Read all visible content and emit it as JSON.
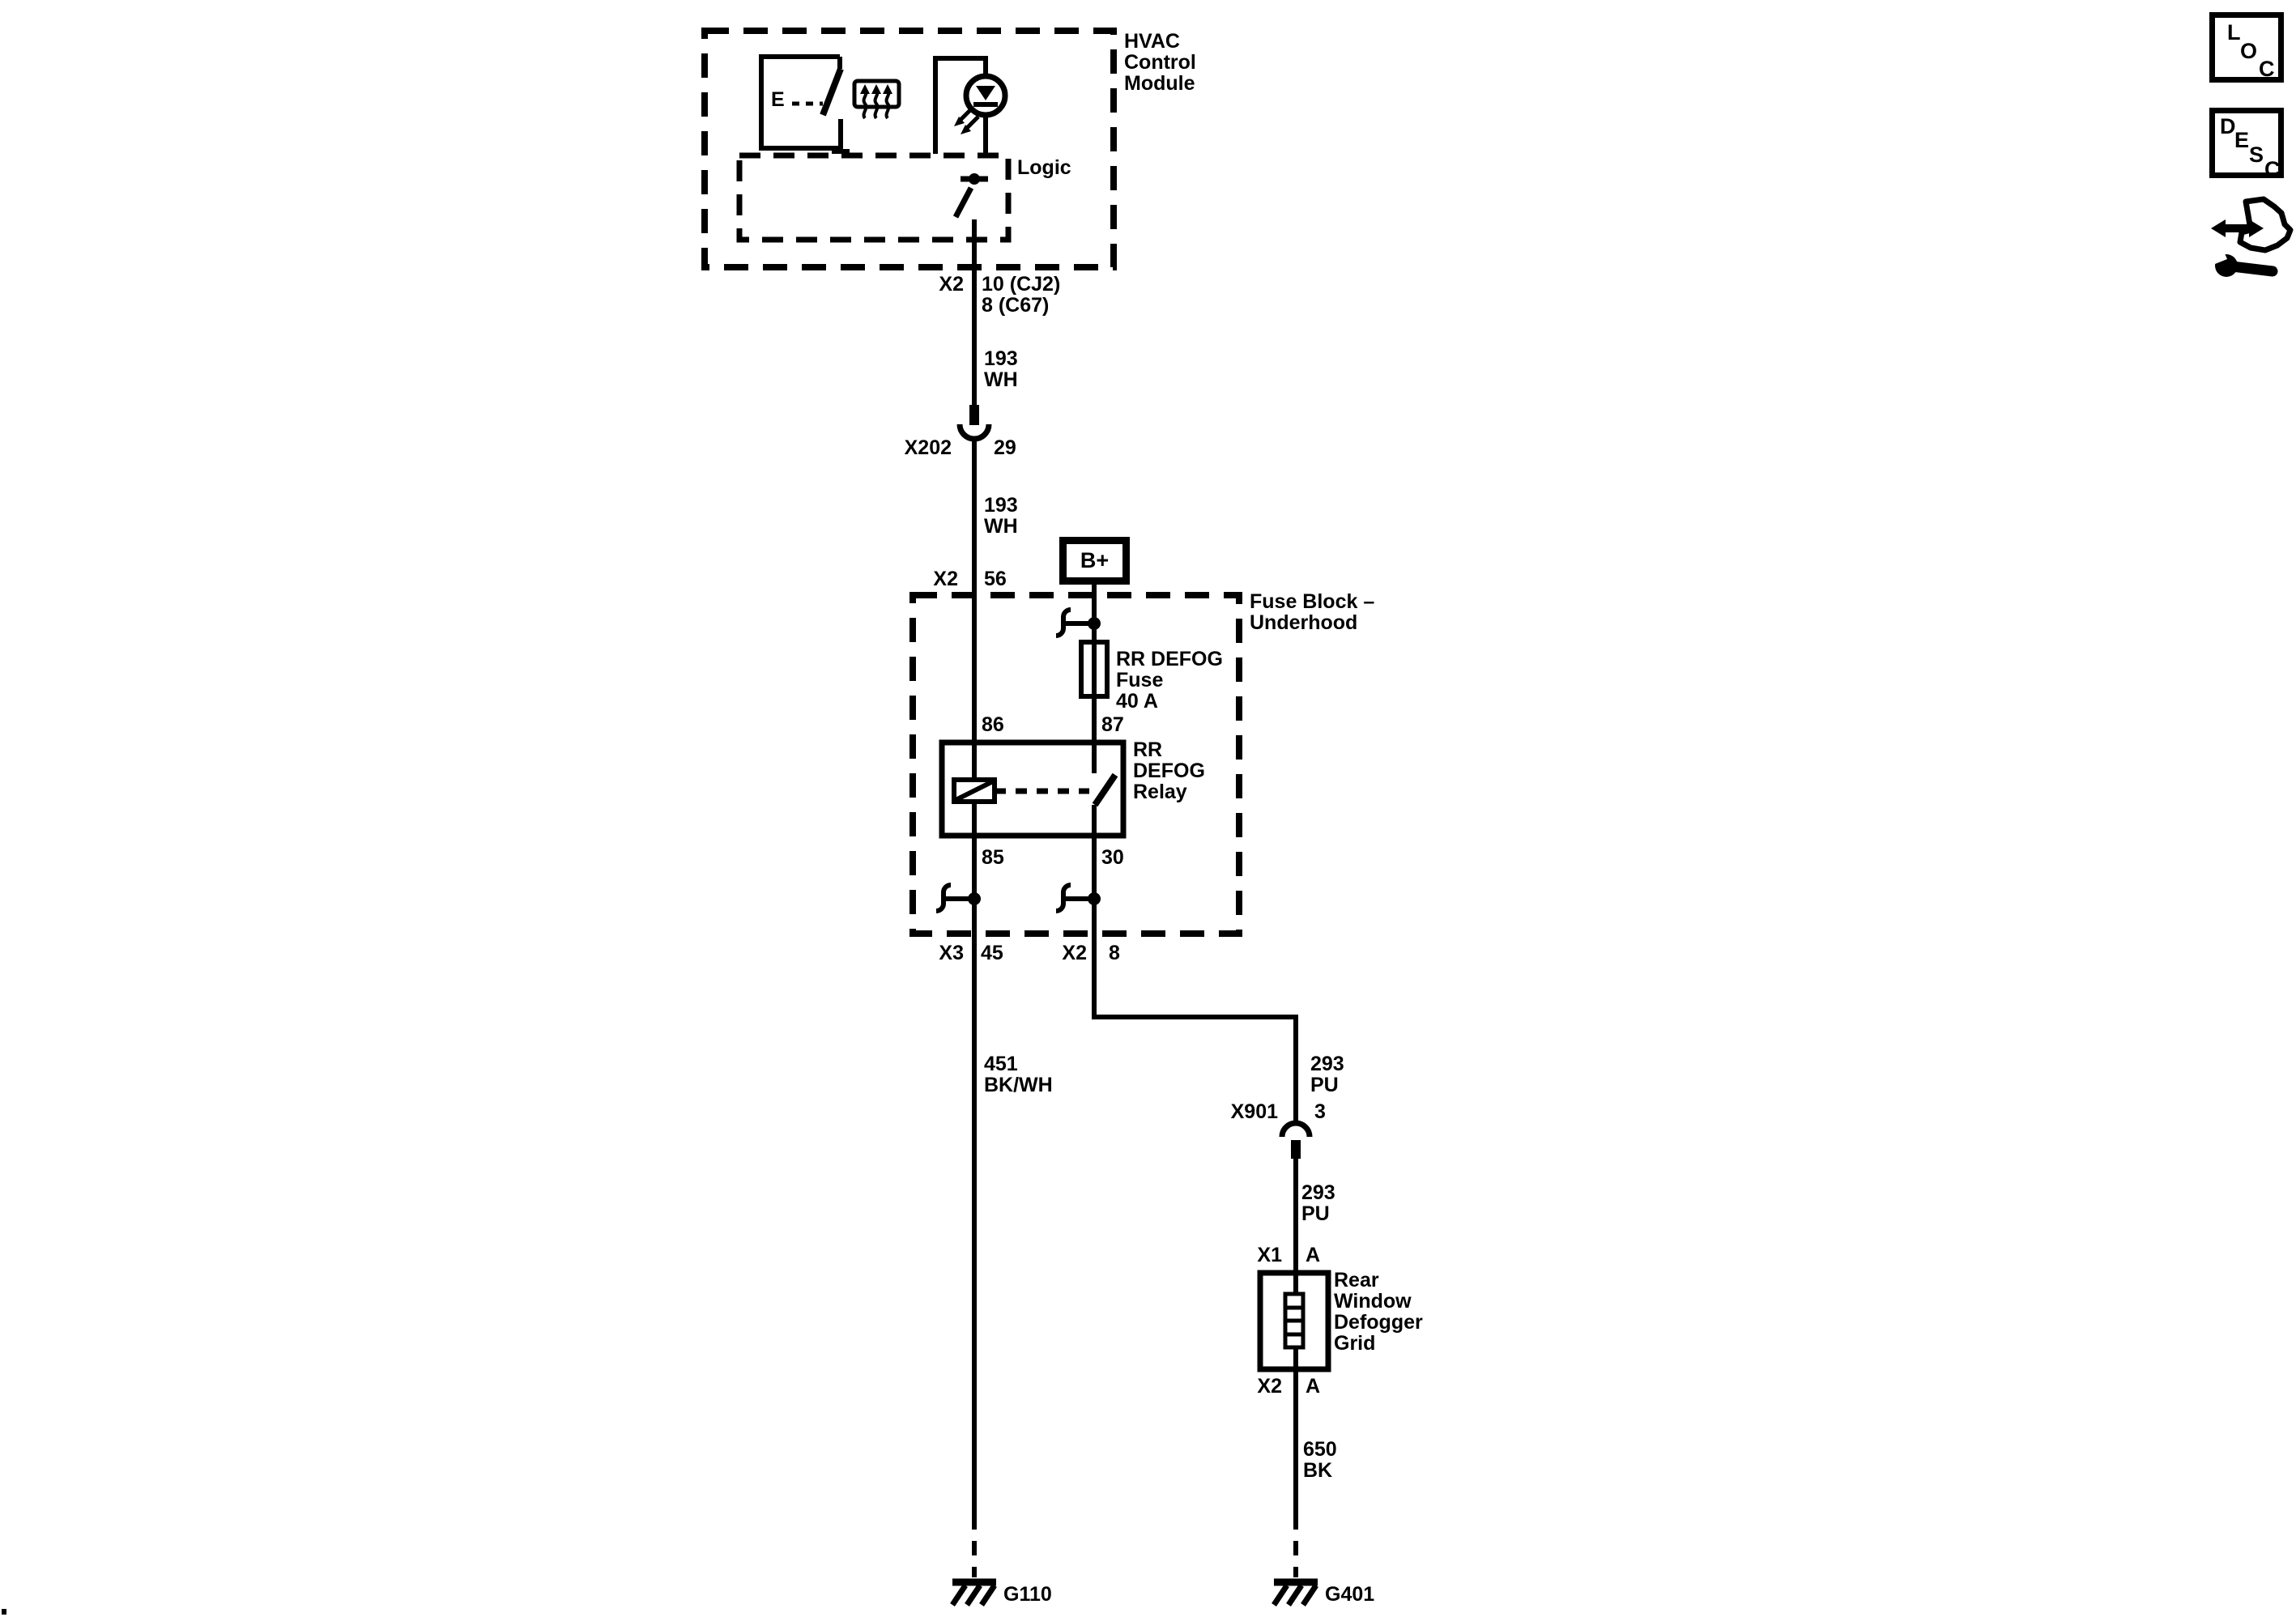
{
  "hvac": {
    "title": "HVAC\nControl\nModule",
    "logic_label": "Logic",
    "switch_actuator": "E"
  },
  "connector_labels": {
    "hvac_out_conn": "X2",
    "hvac_out_pins": "10 (CJ2)\n8 (C67)",
    "x202_name": "X202",
    "x202_pin": "29",
    "fb_in_conn": "X2",
    "fb_in_pin": "56",
    "fb_out_left_conn": "X3",
    "fb_out_left_pin": "45",
    "fb_out_right_conn": "X2",
    "fb_out_right_pin": "8",
    "x901_name": "X901",
    "x901_pin": "3",
    "grid_in_conn": "X1",
    "grid_in_pin": "A",
    "grid_out_conn": "X2",
    "grid_out_pin": "A"
  },
  "power": {
    "b_plus": "B+"
  },
  "fuse_block": {
    "title": "Fuse Block –\nUnderhood",
    "fuse_label": "RR DEFOG\nFuse\n40 A",
    "relay_label": "RR\nDEFOG\nRelay",
    "pin_86": "86",
    "pin_87": "87",
    "pin_85": "85",
    "pin_30": "30"
  },
  "wire_labels": {
    "hvac_to_x202": "193\nWH",
    "x202_to_fb": "193\nWH",
    "fb_to_g110": "451\nBK/WH",
    "fb_to_x901": "293\nPU",
    "x901_to_grid": "293\nPU",
    "grid_to_g401": "650\nBK"
  },
  "defogger_grid": {
    "title": "Rear\nWindow\nDefogger\nGrid"
  },
  "grounds": {
    "left": "G110",
    "right": "G401"
  },
  "nav_icons": {
    "loc_letters": [
      "L",
      "O",
      "C"
    ],
    "desc_letters": [
      "D",
      "E",
      "S",
      "C"
    ]
  }
}
